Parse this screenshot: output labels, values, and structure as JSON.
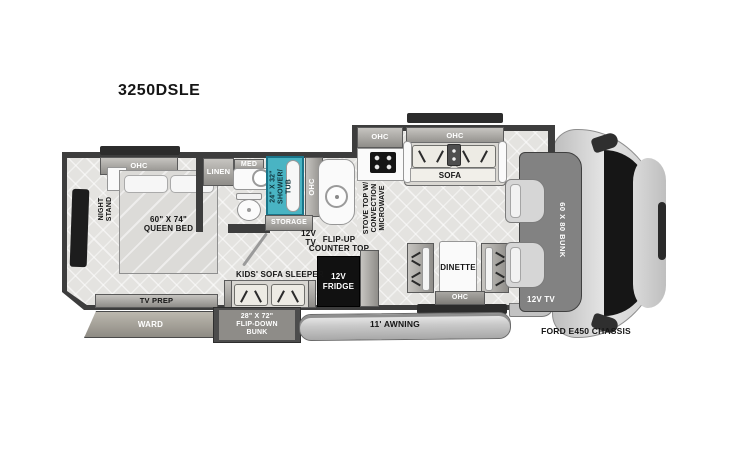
{
  "title": "3250DSLE",
  "colors": {
    "wall": "#3d3d3d",
    "floor": "#e4e3e0",
    "shower_teal": "#49b4c3",
    "fridge_black": "#111111",
    "cab_gray": "#d2d2d2"
  },
  "icons": {
    "stove": "burner-grid",
    "toilet": "toilet-top-view",
    "sink": "round-basin",
    "seatbelt": "v-mark",
    "tv": "flat-panel"
  },
  "bedroom": {
    "ohc": "OHC",
    "night_stand": "NIGHT\nSTAND",
    "queen_bed": "60\" X 74\"\nQUEEN BED",
    "tv_prep": "TV PREP",
    "ward": "WARD"
  },
  "bathroom": {
    "linen": "LINEN",
    "med": "MED",
    "shower": "24\" X 32\"\nSHOWER/\nTUB",
    "ohc": "OHC",
    "storage": "STORAGE",
    "tv": "12V\nTV"
  },
  "kitchen": {
    "flip_up_counter": "FLIP-UP\nCOUNTER TOP",
    "ohc": "OHC",
    "stove": "STOVE TOP W/\nCONVECTION\nMICROWAVE",
    "fridge": "12V\nFRIDGE"
  },
  "living": {
    "sofa": "SOFA",
    "sofa_ohc": "OHC",
    "kids_sofa": "KIDS' SOFA SLEEPER",
    "flip_down_bunk": "28\" X 72\"\nFLIP-DOWN\nBUNK",
    "dinette": "DINETTE",
    "dinette_ohc": "OHC"
  },
  "exterior": {
    "awning": "11' AWNING"
  },
  "cab": {
    "bunk": "60 X 80 BUNK",
    "tv": "12V TV",
    "chassis": "FORD E450 CHASSIS"
  }
}
